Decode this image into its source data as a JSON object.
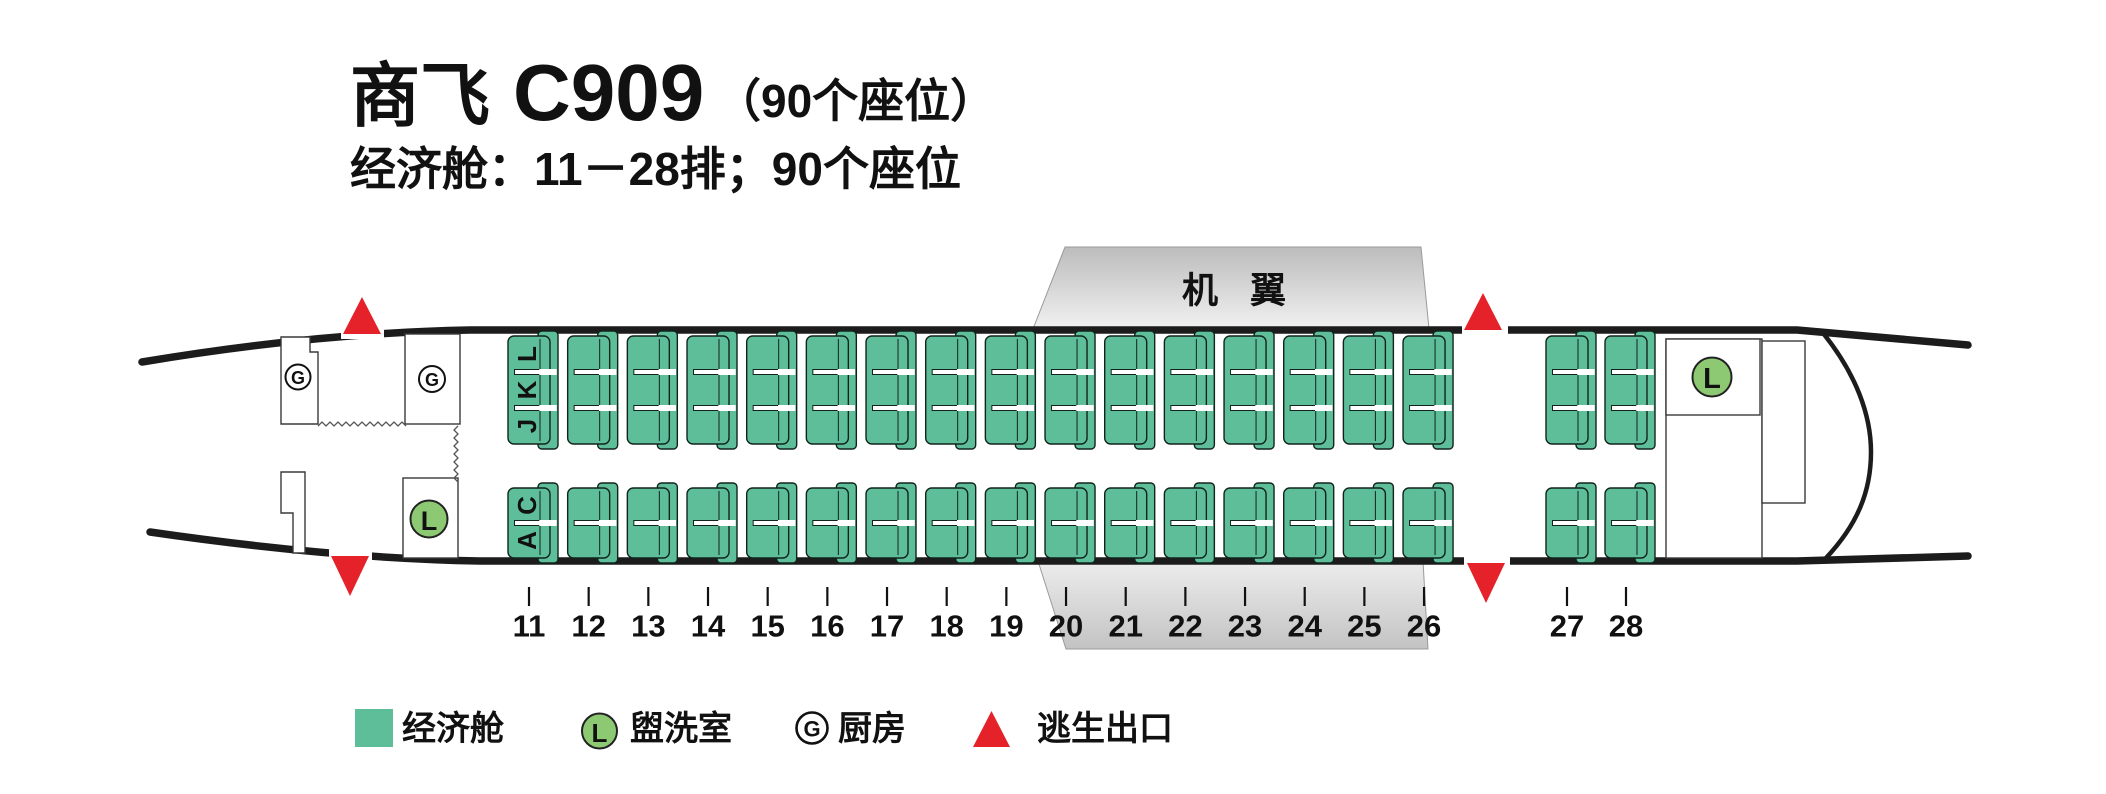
{
  "title": {
    "brand": "商飞",
    "model": "C909",
    "note": "（90个座位）"
  },
  "subtitle": "经济舱：11－28排；90个座位",
  "wing_label": "机 翼",
  "cabin": {
    "rows_main": [
      "11",
      "12",
      "13",
      "14",
      "15",
      "16",
      "17",
      "18",
      "19",
      "20",
      "21",
      "22",
      "23",
      "24",
      "25",
      "26"
    ],
    "rows_rear": [
      "27",
      "28"
    ],
    "letters_top_block": [
      "L",
      "K",
      "J"
    ],
    "letters_bottom_block": [
      "C",
      "A"
    ]
  },
  "icons": {
    "galley_symbol": "G",
    "lavatory_symbol": "L"
  },
  "legend": {
    "items": [
      {
        "type": "seat",
        "label": "经济舱"
      },
      {
        "type": "lavatory",
        "symbol": "L",
        "label": "盥洗室"
      },
      {
        "type": "galley",
        "symbol": "G",
        "label": "厨房"
      },
      {
        "type": "exit",
        "label": "逃生出口"
      }
    ]
  },
  "colors": {
    "seat": "#5FBE9A",
    "lavatory": "#8DC973",
    "exit_red": "#E52129",
    "fuselage_line": "#1c1c1c"
  }
}
